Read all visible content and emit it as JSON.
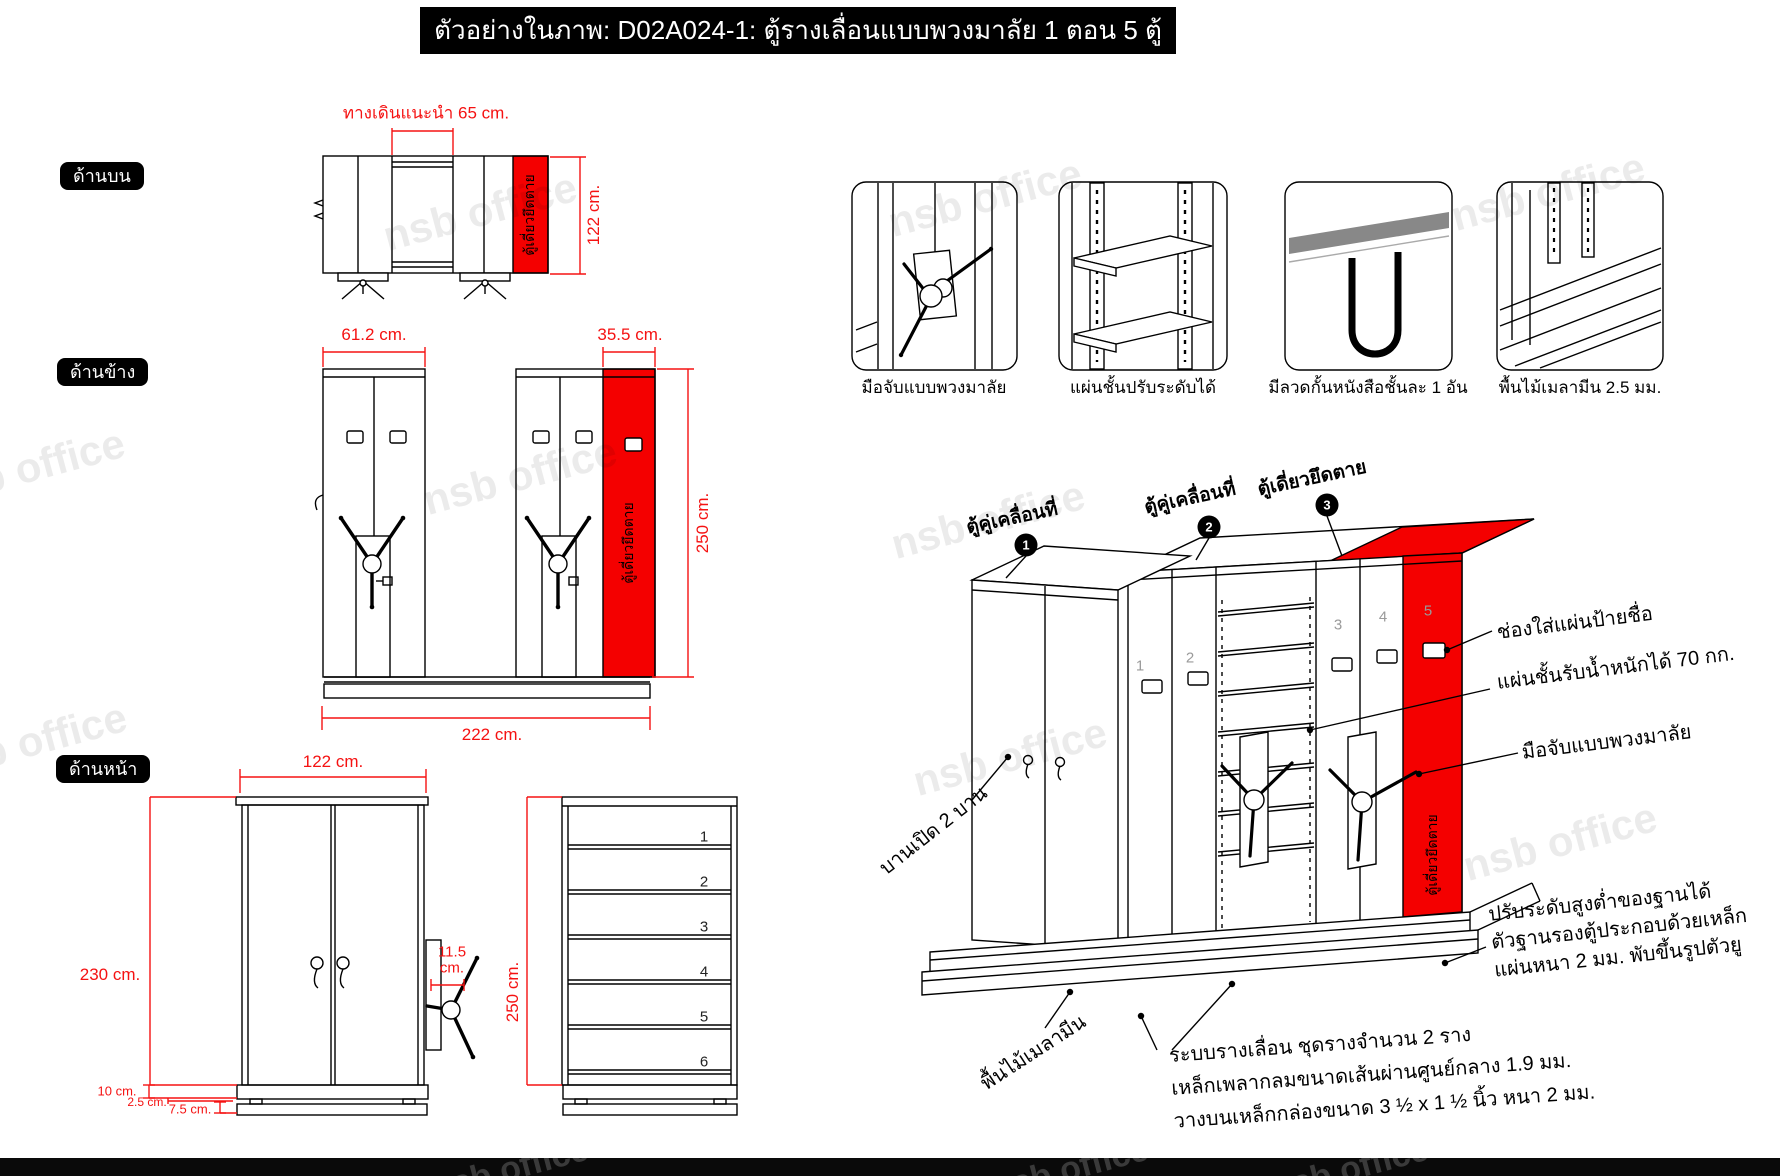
{
  "title": "ตัวอย่างในภาพ: D02A024-1: ตู้รางเลื่อนแบบพวงมาลัย 1 ตอน 5 ตู้",
  "watermark": "nsb office",
  "colors": {
    "accent_red": "#ff0000",
    "dim_red": "#f51212",
    "line_black": "#000000",
    "grey_number": "#9a9a9a"
  },
  "views": {
    "top": {
      "label": "ด้านบน",
      "walkway_dim": "ทางเดินแนะนำ 65 cm.",
      "depth_dim": "122 cm.",
      "fixed_cabinet": "ตู้เดี่ยวยึดตาย"
    },
    "side": {
      "label": "ด้านข้าง",
      "double_unit_dim": "61.2 cm.",
      "fixed_unit_dim": "35.5 cm.",
      "height_dim": "250 cm.",
      "total_length_dim": "222 cm.",
      "fixed_cabinet": "ตู้เดี่ยวยึดตาย"
    },
    "front": {
      "label": "ด้านหน้า",
      "width_dim": "122 cm.",
      "height_dim": "230 cm.",
      "handle_dim_value": "11.5",
      "handle_dim_unit": "cm.",
      "shelf_height_dim": "250 cm.",
      "plinth_dim": "10 cm.",
      "rail_dim": "2.5 cm.",
      "base_dim": "7.5 cm.",
      "shelf_numbers": [
        "1",
        "2",
        "3",
        "4",
        "5",
        "6"
      ]
    }
  },
  "details": [
    {
      "caption": "มือจับแบบพวงมาลัย"
    },
    {
      "caption": "แผ่นชั้นปรับระดับได้"
    },
    {
      "caption": "มีลวดกั้นหนังสือชั้นละ 1 อัน"
    },
    {
      "caption": "พื้นไม้เมลามีน 2.5 มม."
    }
  ],
  "isometric": {
    "units": [
      {
        "number": "1",
        "label": "ตู้คู่เคลื่อนที่"
      },
      {
        "number": "2",
        "label": "ตู้คู่เคลื่อนที่"
      },
      {
        "number": "3",
        "label": "ตู้เดี่ยวยึดตาย"
      }
    ],
    "cabinet_numbers": [
      "1",
      "2",
      "3",
      "4",
      "5"
    ],
    "fixed_cabinet": "ตู้เดี่ยวยึดตาย",
    "annotations": {
      "name_plate": "ช่องใส่แผ่นป้ายชื่อ",
      "shelf_capacity": "แผ่นชั้นรับน้ำหนักได้ 70 กก.",
      "handle": "มือจับแบบพวงมาลัย",
      "doors": "บานเปิด 2 บาน",
      "base_adjust_line1": "ปรับระดับสูงต่ำของฐานได้",
      "base_adjust_line2": "ตัวฐานรองตู้ประกอบด้วยเหล็ก",
      "base_adjust_line3": "แผ่นหนา 2 มม. พับขึ้นรูปตัวยู",
      "floor": "พื้นไม้เมลามีน",
      "rail_line1": "ระบบรางเลื่อน ชุดรางจำนวน 2 ราง",
      "rail_line2": "เหล็กเพลากลมขนาดเส้นผ่านศูนย์กลาง 1.9 มม.",
      "rail_line3": "วางบนเหล็กกล่องขนาด 3 ½ x 1 ½ นิ้ว หนา 2 มม."
    }
  }
}
